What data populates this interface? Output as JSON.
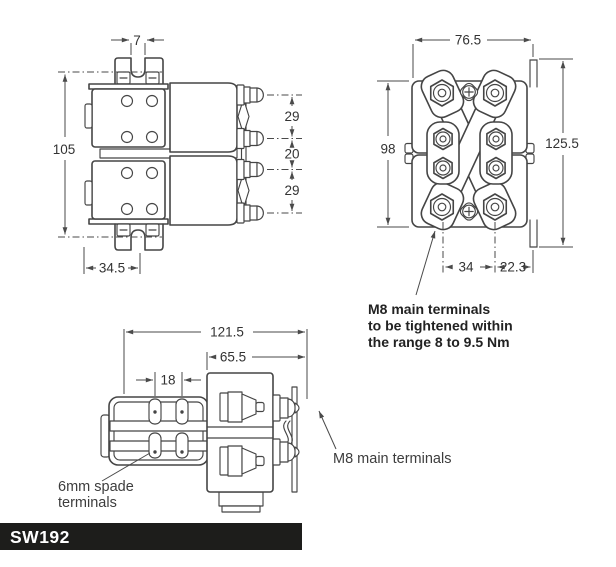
{
  "page": {
    "background": "#ffffff"
  },
  "colors": {
    "line": "#454545",
    "dimension": "#4a4a4a",
    "text": "#333333",
    "footer_bg": "#1d1d1b",
    "footer_text": "#ffffff"
  },
  "views": {
    "side": {
      "name": "Side elevation",
      "dims": {
        "slot_width": "7",
        "overall_height": "105",
        "terminal_pitch_top": "29",
        "terminal_pitch_middle": "20",
        "terminal_pitch_bottom": "29",
        "mounting_offset": "34.5"
      }
    },
    "front": {
      "name": "Front elevation",
      "dims": {
        "body_width": "76.5",
        "body_height": "98",
        "overall_height": "125.5",
        "terminal_spacing": "34",
        "bracket_offset": "22.3"
      },
      "note": {
        "line1": "M8 main terminals",
        "line2": "to be tightened within",
        "line3": "the range 8 to 9.5 Nm"
      }
    },
    "plan": {
      "name": "Plan view",
      "dims": {
        "overall_length": "121.5",
        "body_length": "65.5",
        "spade_spacing": "18"
      },
      "labels": {
        "spade_line1": "6mm spade",
        "spade_line2": "terminals",
        "m8_terminals": "M8 main terminals"
      }
    }
  },
  "footer": {
    "model": "SW192"
  }
}
